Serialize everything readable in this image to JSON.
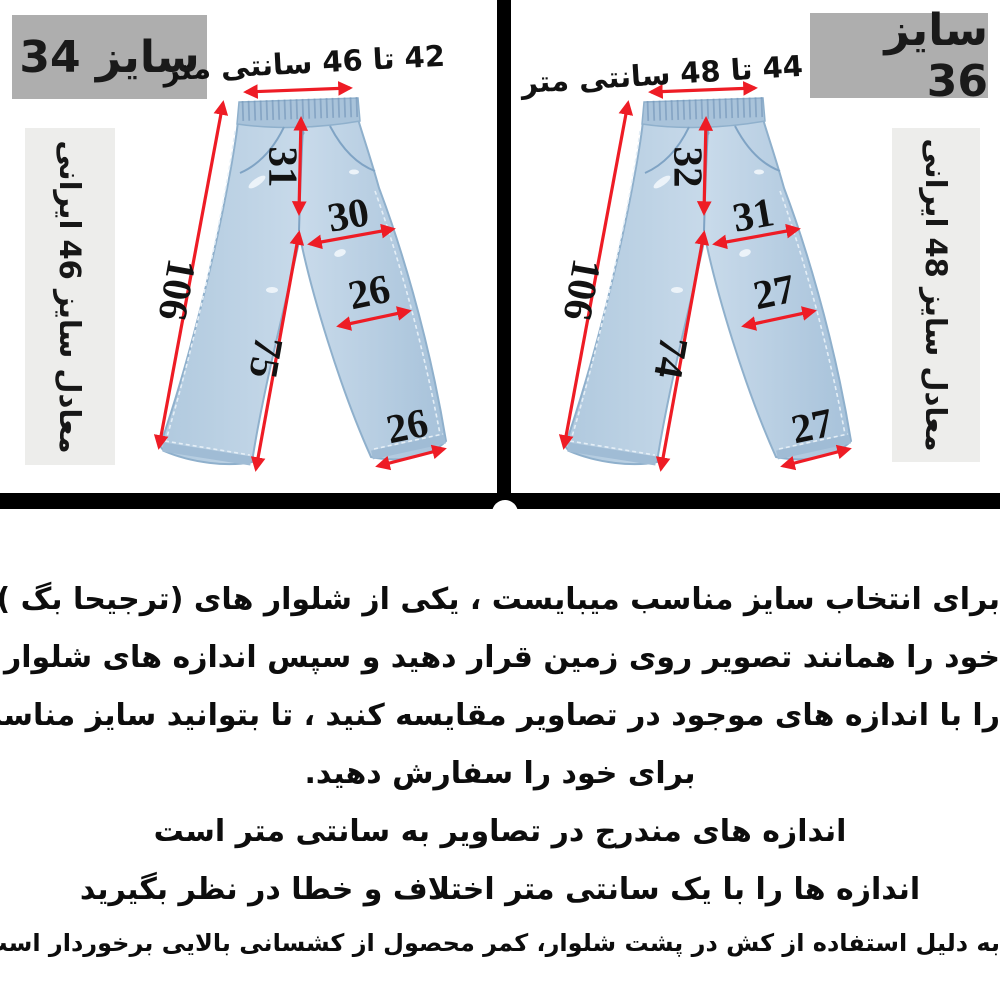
{
  "colors": {
    "arrow_red": "#ee1c25",
    "size_box_gray": "#aeaeae",
    "equiv_box_gray": "#ededeb",
    "denim_blue": "#b5cce0",
    "divider_black": "#000000"
  },
  "left_panel": {
    "size_label": "سایز 34",
    "iran_equivalent_label": "معادل سایز 46 ایرانی",
    "waist_range_label": "42 تا 46 سانتی متر",
    "measurements": {
      "outer_length_cm": "106",
      "front_rise_cm": "31",
      "hip_width_cm": "30",
      "inseam_cm": "75",
      "knee_width_cm": "26",
      "hem_width_cm": "26"
    }
  },
  "right_panel": {
    "size_label": "سایز 36",
    "iran_equivalent_label": "معادل سایز 48 ایرانی",
    "waist_range_label": "44 تا 48 سانتی متر",
    "measurements": {
      "outer_length_cm": "106",
      "front_rise_cm": "32",
      "hip_width_cm": "31",
      "inseam_cm": "74",
      "knee_width_cm": "27",
      "hem_width_cm": "27"
    }
  },
  "instructions": {
    "lines": [
      "برای انتخاب سایز مناسب میبایست ، یکی از شلوار های (ترجیحا بگ )",
      "خود را همانند تصویر روی زمین قرار دهید و سپس اندازه های شلوار خود",
      "را با اندازه های موجود در تصاویر مقایسه کنید ، تا بتوانید سایز مناسب",
      "برای خود را سفارش دهید.",
      "اندازه های مندرج در تصاویر به سانتی متر است",
      "اندازه ها را با یک سانتی متر اختلاف و خطا در نظر بگیرید",
      "به دلیل استفاده از کش در پشت شلوار، کمر محصول از کشسانی بالایی برخوردار است"
    ]
  }
}
